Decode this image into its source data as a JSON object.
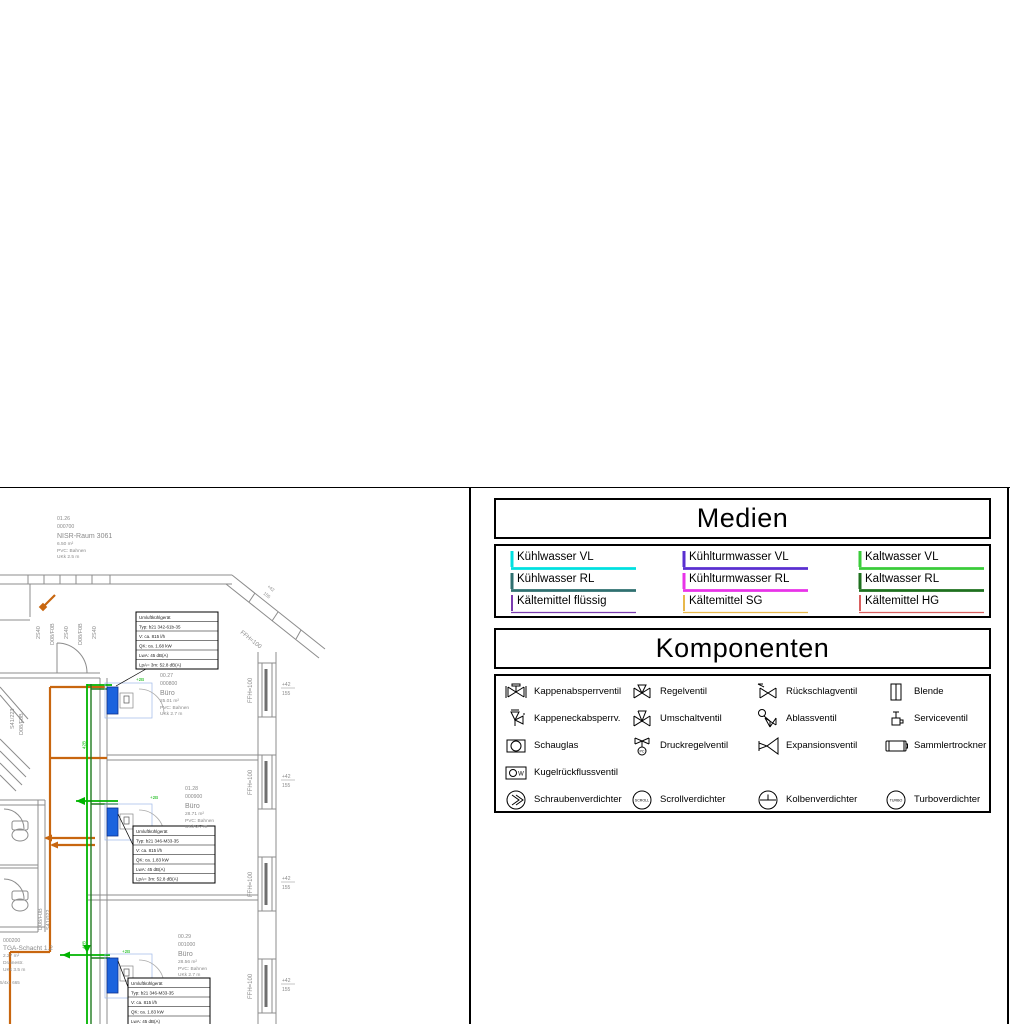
{
  "sheet": {
    "background": "#FFFFFF",
    "frame_color": "#000000"
  },
  "medien": {
    "title": "Medien",
    "entries": [
      {
        "label": "Kühlwasser VL",
        "color": "#00E0E0",
        "weight": "thick"
      },
      {
        "label": "Kühlwasser RL",
        "color": "#2F7070",
        "weight": "thick"
      },
      {
        "label": "Kältemittel flüssig",
        "color": "#7A3BAF",
        "weight": "thin"
      },
      {
        "label": "Kühlturmwasser VL",
        "color": "#5A2FD0",
        "weight": "thick"
      },
      {
        "label": "Kühlturmwasser RL",
        "color": "#E833E8",
        "weight": "thick"
      },
      {
        "label": "Kältemittel SG",
        "color": "#E8B84B",
        "weight": "thin"
      },
      {
        "label": "Kaltwasser VL",
        "color": "#3ACC3A",
        "weight": "thick"
      },
      {
        "label": "Kaltwasser RL",
        "color": "#1E701E",
        "weight": "thick"
      },
      {
        "label": "Kältemittel HG",
        "color": "#D96060",
        "weight": "thin"
      }
    ]
  },
  "komponenten": {
    "title": "Komponenten",
    "items": [
      {
        "label": "Kappenabsperrventil"
      },
      {
        "label": "Regelventil"
      },
      {
        "label": "Rückschlagventil"
      },
      {
        "label": "Blende"
      },
      {
        "label": "Kappeneckabsperrv."
      },
      {
        "label": "Umschaltventil"
      },
      {
        "label": "Ablassventil"
      },
      {
        "label": "Serviceventil"
      },
      {
        "label": "Schauglas"
      },
      {
        "label": "Druckregelventil",
        "badge": "PC"
      },
      {
        "label": "Expansionsventil"
      },
      {
        "label": "Sammlertrockner"
      },
      {
        "label": "Kugelrückflussventil",
        "badge": "W"
      },
      {
        "label": "Schraubenverdichter"
      },
      {
        "label": "Scrollverdichter",
        "badge": "SCROLL"
      },
      {
        "label": "Kolbenverdichter"
      },
      {
        "label": "Turboverdichter",
        "badge": "TURBO"
      }
    ]
  },
  "floorplan": {
    "rooms": [
      {
        "lines": [
          "01.26",
          "000700",
          "NISR-Raum 3061",
          "6.50 m²",
          "PVC: Bahnen",
          "UKk 2.5 m"
        ]
      },
      {
        "lines": [
          "00.27",
          "000800",
          "Büro",
          "25.01 m²",
          "PVC: Bahnen",
          "UKk 2.7 m"
        ]
      },
      {
        "lines": [
          "01.28",
          "000900",
          "Büro",
          "28.71 m²",
          "PVC: Bahnen",
          "UKk 2.7 m"
        ]
      },
      {
        "lines": [
          "00.29",
          "001000",
          "Büro",
          "28.56 m²",
          "PVC: Bahnen",
          "UKk 2.7 m"
        ]
      },
      {
        "lines": [
          "000200",
          "TGA-Schacht 1.2",
          "2.27 m²",
          "Drainestr.",
          "UKk 3.5 m"
        ]
      }
    ],
    "edge_note": "5/4x1 665",
    "unit_tables": [
      {
        "rows": [
          "Umluftkühlgerät",
          "Typ: b21 342-61b-35",
          "V: ca. 815 l/h",
          "QK: ca. 1.68 kW",
          "LwA: 45 dB(A)",
          "LpA= 3m: 52.8 dB(A)"
        ]
      },
      {
        "rows": [
          "Umluftkühlgerät",
          "Typ: b21 346-M33-35",
          "V: ca. 815 l/h",
          "QK: ca. 1.83 kW",
          "LwA: 45 dB(A)",
          "LpA= 3m: 52.8 dB(A)"
        ]
      },
      {
        "rows": [
          "Umluftkühlgerät",
          "Typ: b21 346-M33-35",
          "V: ca. 815 l/h",
          "QK: ca. 1.83 kW",
          "LwA: 45 dB(A)",
          "LpA= 3m: 52.8 dB(A)"
        ]
      }
    ],
    "facade": {
      "ffh": "FFH=100",
      "win_top": "+42",
      "win_bot": "155"
    },
    "wall_labels": {
      "top": [
        "2S40",
        "D08/F0B",
        "2S40",
        "D08/F0B",
        "2S40"
      ],
      "left": [
        "S41/223",
        "D08/F0B"
      ],
      "wc": [
        "D08/F0B",
        "S41/022"
      ]
    },
    "door_dims": [
      "210",
      "50"
    ],
    "pipe_labels": {
      "riser": "42B",
      "unit": "+2B"
    },
    "colors": {
      "wall": "#8C8C8C",
      "glass": "#6E6E6E",
      "pipe_orange": "#C8660F",
      "pipe_green_vl": "#00B400",
      "pipe_green_rl": "#1E7A1E",
      "unit_blue": "#1B63DE",
      "label_gray": "#8A8A8A"
    }
  }
}
